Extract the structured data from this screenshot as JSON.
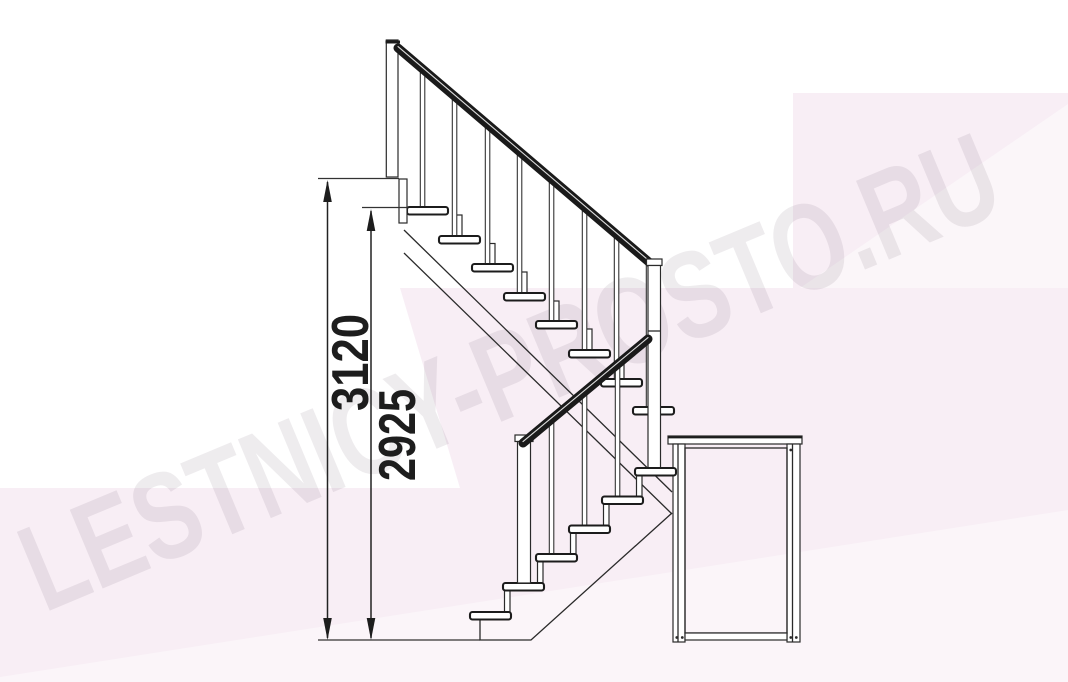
{
  "document": {
    "type": "staircase-side-view-technical-drawing"
  },
  "watermark": {
    "text": "LESTNICY-PROSTO.RU"
  },
  "dimension_labels": {
    "total_height": "3120",
    "flight_height": "2925"
  },
  "colors": {
    "background": "#ffffff",
    "pink_tint": "#f8eef5",
    "line": "#2a2a2a",
    "rail": "#1a1a1a",
    "dimension_text": "#1d1d1d",
    "watermark_tint": "#5c4a5a"
  },
  "structure": {
    "upper_flight_tread_count": 8,
    "lower_flight_tread_count": 6,
    "has_landing_platform": true,
    "has_handrails": true
  }
}
